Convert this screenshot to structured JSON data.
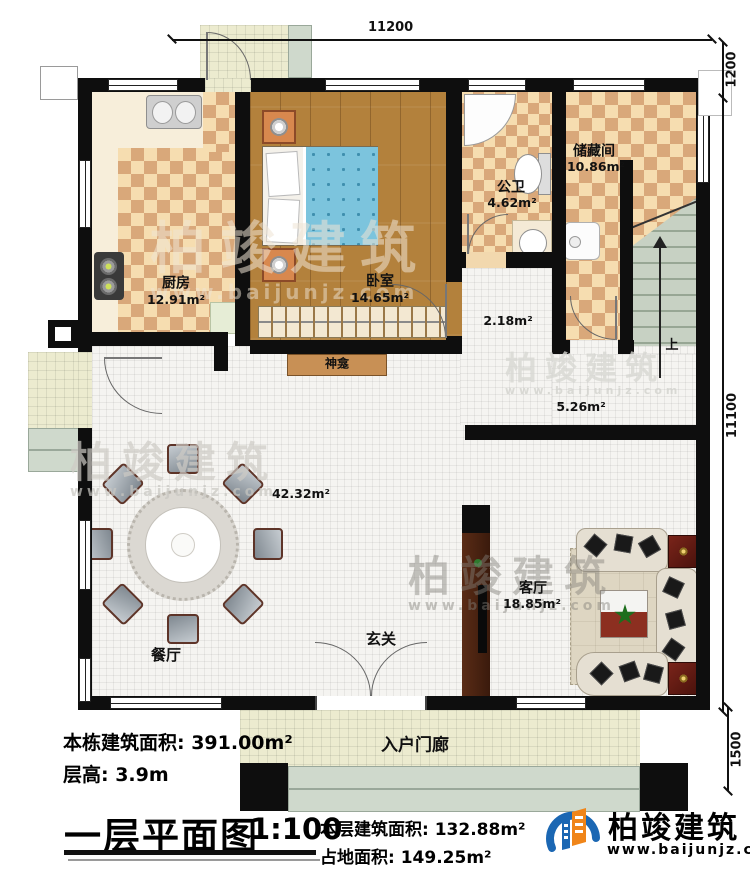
{
  "dims": {
    "top": "11200",
    "right_top": "1200",
    "right_mid": "11100",
    "right_bottom": "1500"
  },
  "rooms": {
    "kitchen_name": "厨房",
    "kitchen_area": "12.91m²",
    "bedroom_name": "卧室",
    "bedroom_area": "14.65m²",
    "bath_name": "公卫",
    "bath_area": "4.62m²",
    "storage_name": "储藏间",
    "storage_area": "10.86m²",
    "hall_small_area": "2.18m²",
    "hall_area": "5.26m²",
    "great_area": "42.32m²",
    "dining_name": "餐厅",
    "foyer_name": "玄关",
    "living_name": "客厅",
    "living_area": "18.85m²",
    "shrine_name": "神龛",
    "porch_name": "入户门廊",
    "stairs_up": "上"
  },
  "title_block": {
    "building_total": "本栋建筑面积: 391.00m²",
    "floor_height": "层高: 3.9m",
    "plan_title": "一层平面图",
    "scale": "1:100",
    "floor_area": "本层建筑面积: 132.88m²",
    "footprint_area": "占地面积: 149.25m²"
  },
  "brand": {
    "name": "柏竣建筑",
    "site": "www.baijunjz.com"
  },
  "watermark": {
    "name": "柏竣建筑",
    "site": "www.baijunjz.com"
  },
  "colors": {
    "wall": "#0e0e0e",
    "brand_blue": "#1b67b3",
    "brand_orange": "#f08519"
  }
}
